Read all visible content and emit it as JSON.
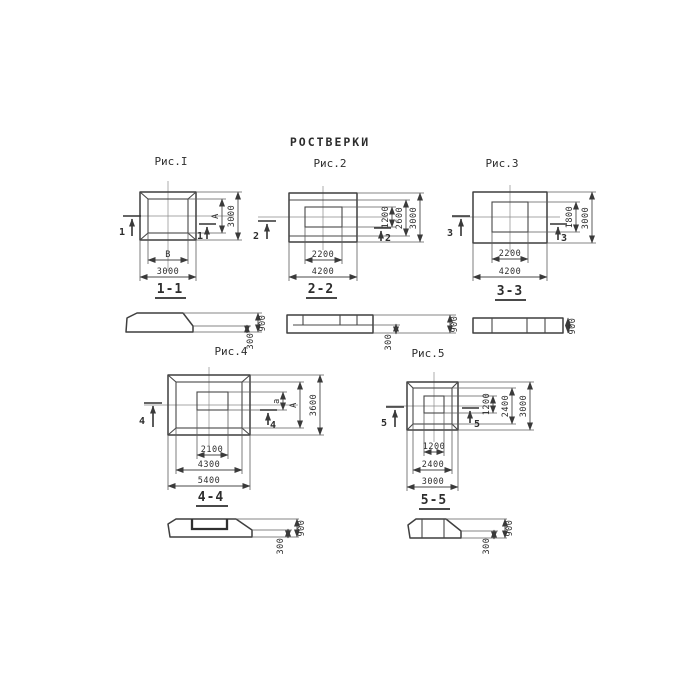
{
  "colors": {
    "ink": "#3d3d3d",
    "paper": "#ffffff"
  },
  "title": "РОСТВЕРКИ",
  "fig1": {
    "caption": "Рис.I",
    "cut_number": "1",
    "plan": {
      "inner_width": "В",
      "outer_width": "3000",
      "inner_height": "А",
      "outer_height": "3000"
    },
    "section": {
      "label": "1-1",
      "step_height": "300",
      "total_height": "900"
    }
  },
  "fig2": {
    "caption": "Рис.2",
    "cut_number": "2",
    "plan": {
      "inner_width": "2200",
      "outer_width": "4200",
      "inner_height": "1200",
      "mid_height": "2600",
      "outer_height": "3000"
    },
    "section": {
      "label": "2-2",
      "step_height": "300",
      "total_height": "900"
    }
  },
  "fig3": {
    "caption": "Рис.3",
    "cut_number": "3",
    "plan": {
      "inner_width": "2200",
      "outer_width": "4200",
      "inner_height": "1800",
      "outer_height": "3000"
    },
    "section": {
      "label": "3-3",
      "total_height": "900"
    }
  },
  "fig4": {
    "caption": "Рис.4",
    "cut_number": "4",
    "plan": {
      "inner_width": "2100",
      "mid_width": "4300",
      "outer_width": "5400",
      "inner_height": "а",
      "mid_height": "А",
      "outer_height": "3600"
    },
    "section": {
      "label": "4-4",
      "step_height": "300",
      "total_height": "900"
    }
  },
  "fig5": {
    "caption": "Рис.5",
    "cut_number": "5",
    "plan": {
      "inner_width": "1200",
      "mid_width": "2400",
      "outer_width": "3000",
      "inner_height": "1200",
      "mid_height": "2400",
      "outer_height": "3000"
    },
    "section": {
      "label": "5-5",
      "step_height": "300",
      "total_height": "900"
    }
  }
}
